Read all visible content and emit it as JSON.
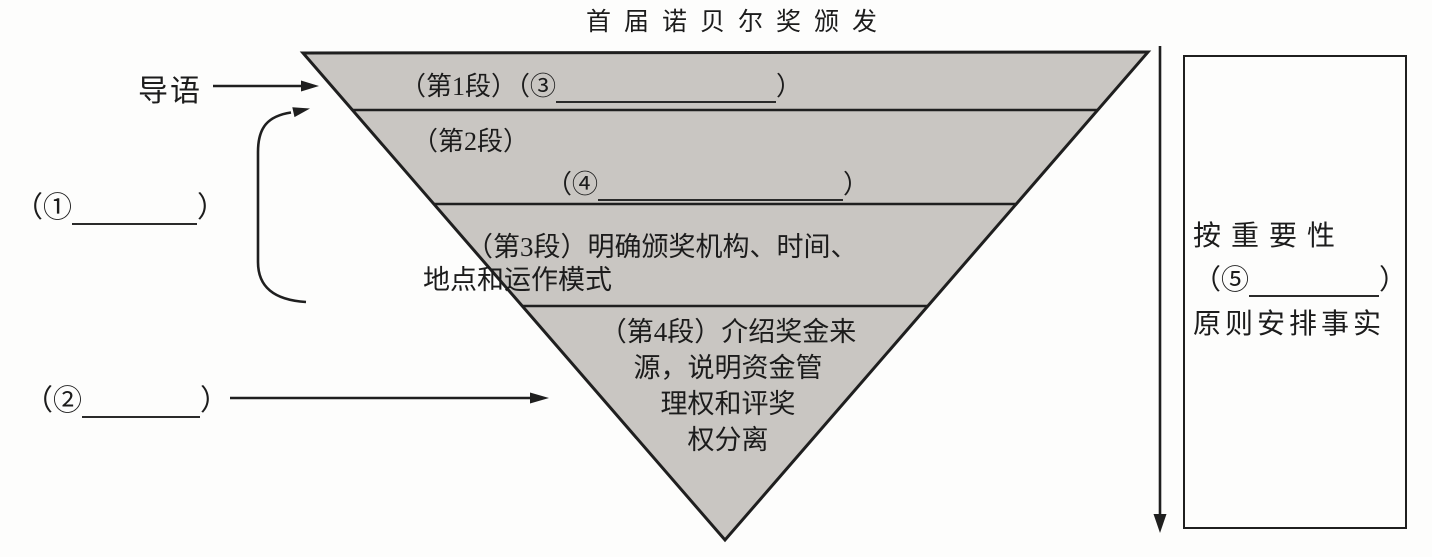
{
  "title": "首届诺贝尔奖颁发",
  "colors": {
    "pyramid_fill": "#c9c6c2",
    "line": "#1f1f1f",
    "text": "#1c1c1c",
    "background": "#fdfdfc"
  },
  "left": {
    "lead_label": "导语",
    "blank1_prefix": "（①",
    "blank1_suffix": "）",
    "blank2_prefix": "（②",
    "blank2_suffix": "）"
  },
  "pyramid": {
    "band1": {
      "text_prefix": "（第1段）（③",
      "text_suffix": "）"
    },
    "band2": {
      "label": "（第2段）",
      "blank_prefix": "（④",
      "blank_suffix": "）"
    },
    "band3": {
      "line1": "（第3段）明确颁奖机构、时间、",
      "line2": "地点和运作模式"
    },
    "band4": {
      "line1": "（第4段）介绍奖金来",
      "line2": "源，说明资金管",
      "line3": "理权和评奖",
      "line4": "权分离"
    }
  },
  "right": {
    "line1": "按重要性",
    "blank_prefix": "（⑤",
    "blank_suffix": "）",
    "line2": "原则安排事实"
  }
}
